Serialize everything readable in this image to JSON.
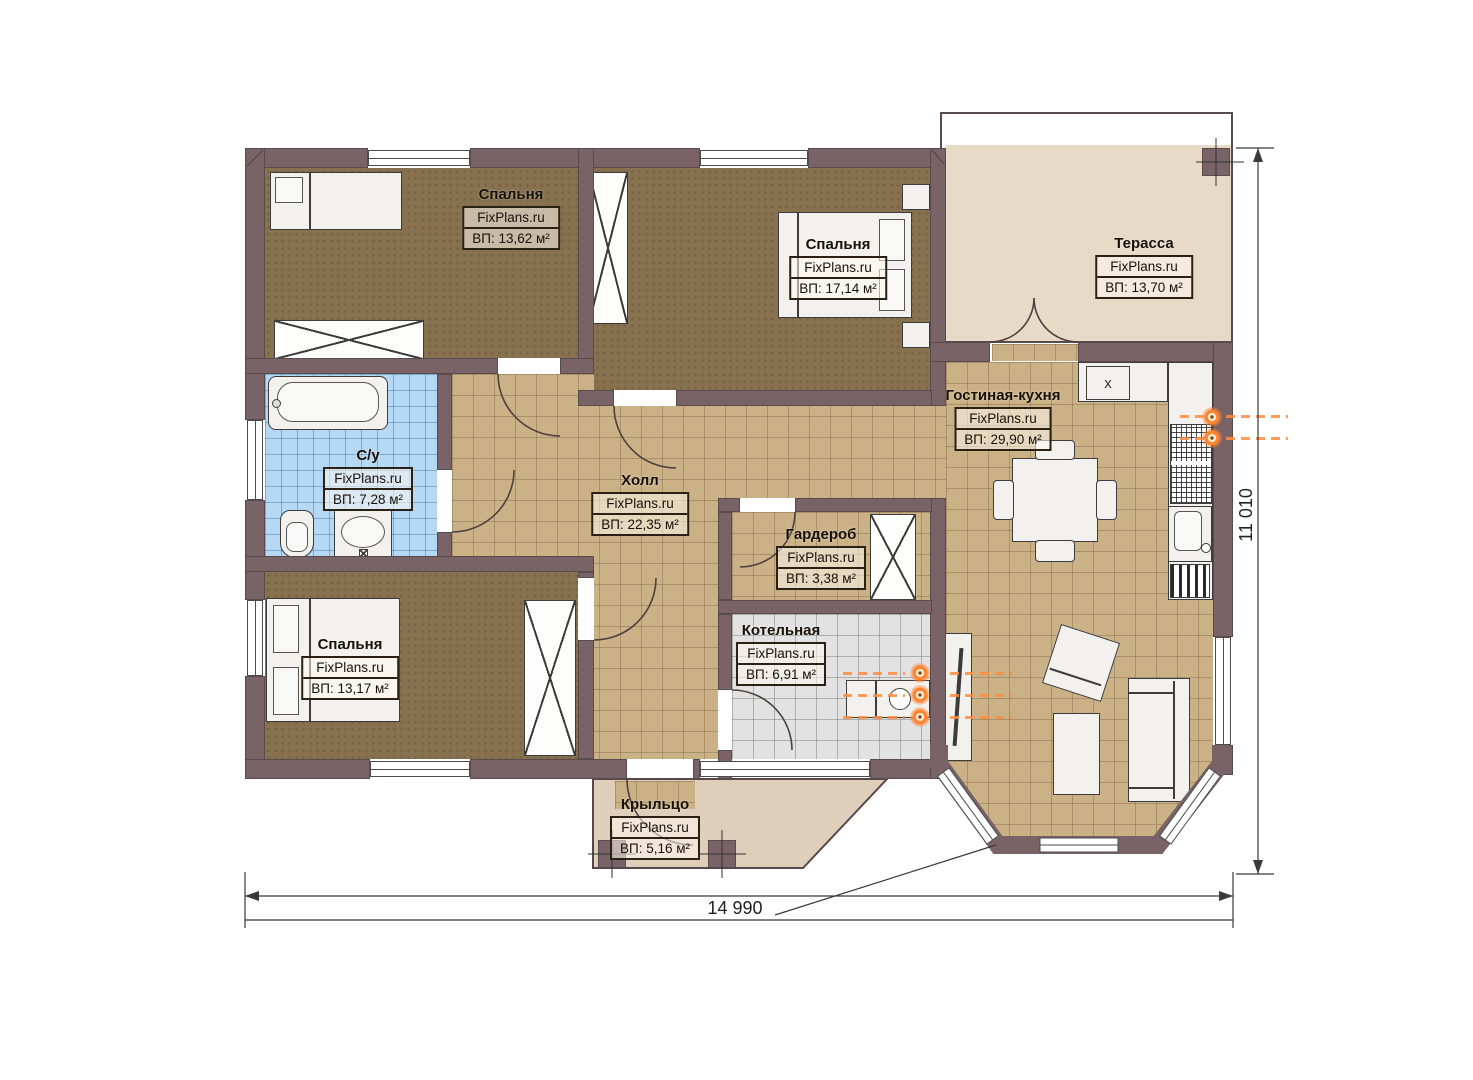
{
  "plan": {
    "brand": "FixPlans.ru",
    "rooms": [
      {
        "id": "bedroom-top-left",
        "name": "Спальня",
        "brand": "FixPlans.ru",
        "area": "ВП: 13,62 м²"
      },
      {
        "id": "bedroom-top-right",
        "name": "Спальня",
        "brand": "FixPlans.ru",
        "area": "ВП: 17,14 м²"
      },
      {
        "id": "terrace",
        "name": "Терасса",
        "brand": "FixPlans.ru",
        "area": "ВП: 13,70 м²"
      },
      {
        "id": "bathroom",
        "name": "С/у",
        "brand": "FixPlans.ru",
        "area": "ВП: 7,28 м²"
      },
      {
        "id": "hall",
        "name": "Холл",
        "brand": "FixPlans.ru",
        "area": "ВП: 22,35 м²"
      },
      {
        "id": "living-kitchen",
        "name": "Гостиная-кухня",
        "brand": "FixPlans.ru",
        "area": "ВП: 29,90 м²"
      },
      {
        "id": "wardrobe",
        "name": "Гардероб",
        "brand": "FixPlans.ru",
        "area": "ВП: 3,38 м²"
      },
      {
        "id": "bedroom-bottom-left",
        "name": "Спальня",
        "brand": "FixPlans.ru",
        "area": "ВП: 13,17 м²"
      },
      {
        "id": "boiler-room",
        "name": "Котельная",
        "brand": "FixPlans.ru",
        "area": "ВП: 6,91 м²"
      },
      {
        "id": "porch",
        "name": "Крыльцо",
        "brand": "FixPlans.ru",
        "area": "ВП: 5,16 м²"
      }
    ],
    "dimensions": {
      "width_label": "14 990",
      "height_label": "11 010"
    },
    "kitchen": {
      "hob_mark": "x"
    },
    "colors": {
      "wall": "#7a6366",
      "tile": "#cbb286",
      "bedroom_floor": "#87714f",
      "bath_tile": "#b5d8f5",
      "boiler_tile": "#e2e2e2",
      "terrace_floor": "#e7dac7",
      "porch_floor": "#dfcfba",
      "radiator_orange": "#ff8432"
    }
  }
}
